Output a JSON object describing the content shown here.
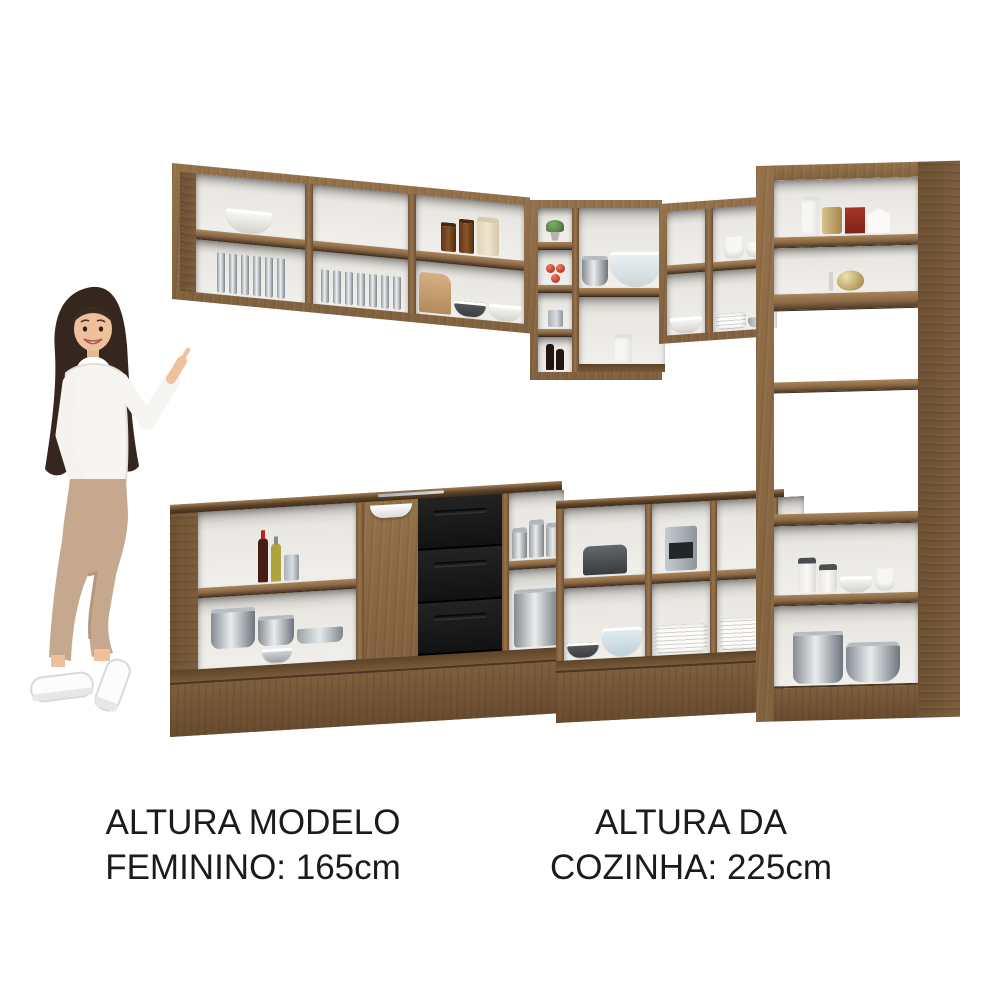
{
  "image": {
    "kind": "furniture-product-photo",
    "background": "#ffffff",
    "subject": "L-shaped corner kitchen cabinet set with open shelves shown full of kitchenware, with a female model pointing at it"
  },
  "captions": {
    "model": {
      "line1": "ALTURA MODELO",
      "line2": "FEMININO: 165cm"
    },
    "kitchen": {
      "line1": "ALTURA DA",
      "line2": "COZINHA: 225cm"
    }
  },
  "measurements": {
    "model_height_cm": 165,
    "kitchen_height_cm": 225
  },
  "colors": {
    "page_bg": "#ffffff",
    "wood_main": "#93714a",
    "wood_mid": "#82613e",
    "wood_dark": "#6e5134",
    "wood_edge": "#4e3a26",
    "interior": "#f1efeb",
    "interior_shadow": "#c7c4bf",
    "drawer_black": "#161616",
    "text": "#1b1b1b"
  },
  "scene": {
    "model": "smiling woman, long dark hair, white sweater, beige trousers, white sneakers, right hand raised pointing at the cabinets",
    "upper_left_cabinet": [
      "white bowl",
      "stacked cups",
      "cups and saucers",
      "drinking glasses",
      "brown jars",
      "cream jar",
      "cutting board",
      "stacked bowls"
    ],
    "corner_wall_cabinet": [
      "plant pot",
      "tomatoes",
      "metal mug",
      "wine bottles",
      "glass bowl",
      "stacked white bowls"
    ],
    "upper_right_cabinet": [
      "white canisters",
      "white bowls",
      "plates",
      "platter"
    ],
    "tall_cabinet": [
      "white canister",
      "gold tin",
      "red box",
      "napkins",
      "books",
      "gold kettle",
      "white ceramic jars",
      "white bowls",
      "metal pots"
    ],
    "base_left_cabinet": [
      "pink bowls",
      "wine bottle",
      "oil bottle",
      "utensil cup",
      "pots and pans",
      "sink bowl",
      "three black drawers",
      "metal canisters",
      "stock pot"
    ],
    "base_right_cabinet": [
      "toaster",
      "coffee machine",
      "white bowls",
      "graters",
      "dark bowl",
      "blue glass bowl",
      "stacked plates"
    ]
  }
}
